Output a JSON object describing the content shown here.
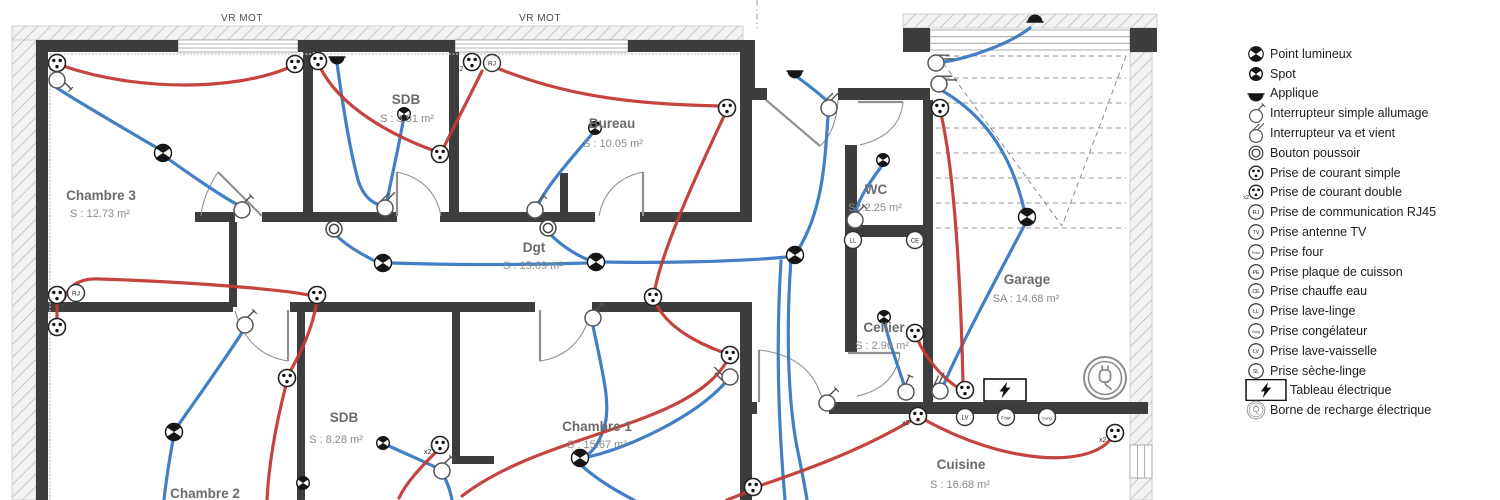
{
  "colors": {
    "wall": "#3d3d3d",
    "wire_blue": "#3878c2",
    "wire_red": "#c23a36",
    "door": "#909090",
    "hatch": "#b3b3b3",
    "stairs": "#9a9a9a",
    "room_name": "#6b6b6b",
    "room_area": "#8a8a8a",
    "legend_text": "#1d1d1d"
  },
  "legend": {
    "items": [
      {
        "symbol": "point-lumineux",
        "label": "Point lumineux"
      },
      {
        "symbol": "spot",
        "label": "Spot"
      },
      {
        "symbol": "applique",
        "label": "Applique"
      },
      {
        "symbol": "int-simple",
        "label": "Interrupteur simple allumage"
      },
      {
        "symbol": "int-vv",
        "label": "Interrupteur va et vient"
      },
      {
        "symbol": "bouton",
        "label": "Bouton poussoir"
      },
      {
        "symbol": "prise",
        "label": "Prise de courant simple"
      },
      {
        "symbol": "prise-x2",
        "label": "Prise de courant double"
      },
      {
        "symbol": "rj45",
        "label": "Prise de communication RJ45"
      },
      {
        "symbol": "tv",
        "label": "Prise antenne TV"
      },
      {
        "symbol": "four",
        "label": "Prise four"
      },
      {
        "symbol": "pe",
        "label": "Prise plaque de cuisson"
      },
      {
        "symbol": "ce",
        "label": "Prise chauffe eau"
      },
      {
        "symbol": "ll",
        "label": "Prise lave-linge"
      },
      {
        "symbol": "cong",
        "label": "Prise congélateur"
      },
      {
        "symbol": "lv",
        "label": "Prise lave-vaisselle"
      },
      {
        "symbol": "sl",
        "label": "Prise sèche-linge"
      },
      {
        "symbol": "tableau",
        "label": "Tableau électrique"
      },
      {
        "symbol": "borne",
        "label": "Borne de recharge électrique"
      }
    ]
  },
  "plan": {
    "window_labels": [
      {
        "text": "VR MOT",
        "x": 242,
        "y": 21
      },
      {
        "text": "VR MOT",
        "x": 540,
        "y": 21
      }
    ],
    "rooms": [
      {
        "name": "Chambre 3",
        "area": "S : 12.73 m²",
        "x": 101,
        "y": 200,
        "ax": 100,
        "ay": 217
      },
      {
        "name": "SDB",
        "area": "S : 3.91 m²",
        "x": 406,
        "y": 104,
        "ax": 407,
        "ay": 122
      },
      {
        "name": "Bureau",
        "area": "S : 10.05 m²",
        "x": 612,
        "y": 128,
        "ax": 613,
        "ay": 147
      },
      {
        "name": "WC",
        "area": "S : 2.25 m²",
        "x": 876,
        "y": 194,
        "ax": 875,
        "ay": 211
      },
      {
        "name": "Dgt",
        "area": "S : 15.69 m²",
        "x": 534,
        "y": 252,
        "ax": 533,
        "ay": 269
      },
      {
        "name": "Chambre 1",
        "area": "S : 15.67 m²",
        "x": 597,
        "y": 431,
        "ax": 597,
        "ay": 448
      },
      {
        "name": "Chambre 2",
        "area": "",
        "x": 205,
        "y": 498,
        "ax": 205,
        "ay": 516
      },
      {
        "name": "SDB",
        "area": "S : 8.28 m²",
        "x": 344,
        "y": 422,
        "ax": 336,
        "ay": 443
      },
      {
        "name": "Cellier",
        "area": "S : 2.96 m²",
        "x": 884,
        "y": 332,
        "ax": 882,
        "ay": 349
      },
      {
        "name": "Garage",
        "area": "SA : 14.68 m²",
        "x": 1027,
        "y": 284,
        "ax": 1026,
        "ay": 302
      },
      {
        "name": "Cuisine",
        "area": "S : 16.68 m²",
        "x": 961,
        "y": 469,
        "ax": 960,
        "ay": 488
      }
    ],
    "walls": [
      [
        36,
        40,
        12,
        460
      ],
      [
        36,
        40,
        142,
        12
      ],
      [
        298,
        40,
        157,
        12
      ],
      [
        628,
        40,
        127,
        12
      ],
      [
        743,
        52,
        12,
        40
      ],
      [
        743,
        88,
        24,
        12
      ],
      [
        838,
        88,
        92,
        12
      ],
      [
        740,
        52,
        12,
        170
      ],
      [
        740,
        302,
        12,
        198
      ],
      [
        845,
        145,
        12,
        80
      ],
      [
        845,
        225,
        88,
        12
      ],
      [
        845,
        237,
        12,
        115
      ],
      [
        923,
        100,
        10,
        310
      ],
      [
        303,
        52,
        10,
        166
      ],
      [
        449,
        52,
        10,
        166
      ],
      [
        560,
        173,
        8,
        47
      ],
      [
        195,
        212,
        40,
        10
      ],
      [
        262,
        212,
        135,
        10
      ],
      [
        440,
        212,
        155,
        10
      ],
      [
        640,
        212,
        100,
        10
      ],
      [
        229,
        222,
        8,
        85
      ],
      [
        48,
        302,
        185,
        10
      ],
      [
        290,
        302,
        245,
        10
      ],
      [
        592,
        302,
        148,
        10
      ],
      [
        297,
        307,
        8,
        193
      ],
      [
        452,
        307,
        8,
        156
      ],
      [
        452,
        456,
        42,
        8
      ],
      [
        740,
        402,
        17,
        12
      ],
      [
        829,
        402,
        319,
        12
      ],
      [
        903,
        28,
        27,
        24
      ],
      [
        1130,
        28,
        27,
        24
      ]
    ],
    "hatch_bands": [
      [
        12,
        28,
        24,
        472
      ],
      [
        12,
        26,
        731,
        14
      ],
      [
        903,
        14,
        254,
        14
      ],
      [
        1130,
        52,
        22,
        448
      ]
    ],
    "windows": [
      {
        "x": 178,
        "y": 40,
        "w": 120,
        "h": 12,
        "v": false
      },
      {
        "x": 455,
        "y": 40,
        "w": 173,
        "h": 12,
        "v": false
      },
      {
        "x": 930,
        "y": 30,
        "w": 200,
        "h": 20,
        "v": false
      },
      {
        "x": 1130,
        "y": 445,
        "w": 22,
        "h": 33,
        "v": true
      }
    ],
    "insulation": [
      [
        50,
        54,
        740,
        54
      ],
      [
        50,
        54,
        50,
        500
      ]
    ],
    "boundary_dashdot": [
      [
        757,
        0,
        757,
        28
      ]
    ],
    "stairs": {
      "x1": 936,
      "x2": 1126,
      "h_lines": [
        78,
        103,
        128,
        153,
        178,
        203,
        228
      ],
      "diagonals": [
        [
          938,
          56,
          1062,
          226
        ],
        [
          1126,
          56,
          1062,
          226
        ],
        [
          936,
          56,
          1126,
          56
        ]
      ]
    },
    "doors": [
      {
        "leaf": "M262,216 L218,172",
        "arc": "M218,172 Q203,195 201,216"
      },
      {
        "leaf": "M397,216 L397,172",
        "arc": "M397,172 Q434,180 441,216"
      },
      {
        "leaf": "M643,216 L643,172",
        "arc": "M643,172 Q606,180 599,216"
      },
      {
        "leaf": "M858,102 L903,102",
        "arc": "M903,102 Q900,135 860,145"
      },
      {
        "leaf": "M766,100 L820,146",
        "arc": "M838,100 Q836,132 820,146"
      },
      {
        "leaf": "M848,353 L900,353",
        "arc": "M900,353 Q895,388 857,396"
      },
      {
        "leaf": "M288,310 L288,361",
        "arc": "M288,361 Q248,355 235,311"
      },
      {
        "leaf": "M540,310 L540,361",
        "arc": "M540,361 Q580,355 591,311"
      },
      {
        "leaf": "M759,402 L759,350",
        "arc": "M759,350 Q812,356 823,402"
      }
    ],
    "wires": [
      {
        "c": "blue",
        "d": "M57,88 C80,103 130,132 159,149"
      },
      {
        "c": "blue",
        "d": "M167,158 C192,176 223,197 238,205"
      },
      {
        "c": "blue",
        "d": "M337,63 C342,100 350,150 358,180 C363,196 372,203 380,205"
      },
      {
        "c": "blue",
        "d": "M403,122 C398,150 391,180 387,201"
      },
      {
        "c": "blue",
        "d": "M592,134 C570,160 547,186 539,203"
      },
      {
        "c": "blue",
        "d": "M881,167 C869,183 858,200 856,212"
      },
      {
        "c": "blue",
        "d": "M796,76 C808,85 820,94 826,100"
      },
      {
        "c": "blue",
        "d": "M828,116 C825,160 823,210 798,250"
      },
      {
        "c": "blue",
        "d": "M787,257 C735,262 655,263 604,262"
      },
      {
        "c": "blue",
        "d": "M588,263 C520,265 450,265 391,263"
      },
      {
        "c": "blue",
        "d": "M375,261 C357,252 344,243 337,236"
      },
      {
        "c": "blue",
        "d": "M551,235 C563,247 578,256 589,260"
      },
      {
        "c": "blue",
        "d": "M1030,28 C1008,45 968,58 944,62"
      },
      {
        "c": "blue",
        "d": "M941,90 C990,118 1013,162 1024,209"
      },
      {
        "c": "blue",
        "d": "M1024,226 C1000,272 962,342 944,384"
      },
      {
        "c": "blue",
        "d": "M885,324 C890,346 899,368 904,385"
      },
      {
        "c": "blue",
        "d": "M593,326 C601,366 611,402 605,424 C600,443 592,452 586,456"
      },
      {
        "c": "blue",
        "d": "M588,457 C630,447 693,418 725,383"
      },
      {
        "c": "blue",
        "d": "M582,466 C598,480 616,491 634,500"
      },
      {
        "c": "blue",
        "d": "M177,427 C200,394 230,352 243,331"
      },
      {
        "c": "blue",
        "d": "M173,440 C169,462 166,481 164,500"
      },
      {
        "c": "blue",
        "d": "M389,446 C406,454 423,461 435,467"
      },
      {
        "c": "blue",
        "d": "M445,478 C449,487 451,494 452,500"
      },
      {
        "c": "blue",
        "d": "M791,259 C786,330 788,395 796,442 C801,468 805,486 807,500"
      },
      {
        "c": "blue",
        "d": "M781,261 C776,340 778,420 785,500"
      },
      {
        "c": "red",
        "d": "M63,66 C140,92 235,90 288,68"
      },
      {
        "c": "red",
        "d": "M320,67 C340,108 394,136 432,150"
      },
      {
        "c": "red",
        "d": "M482,71 C466,104 452,130 444,147"
      },
      {
        "c": "red",
        "d": "M497,68 C575,100 648,104 719,106"
      },
      {
        "c": "red",
        "d": "M725,114 C701,165 664,244 655,289"
      },
      {
        "c": "red",
        "d": "M656,303 C667,328 700,344 722,352"
      },
      {
        "c": "red",
        "d": "M727,361 C688,428 545,432 462,496"
      },
      {
        "c": "red",
        "d": "M941,114 C956,180 961,300 963,382"
      },
      {
        "c": "red",
        "d": "M917,338 C927,362 946,380 957,387"
      },
      {
        "c": "red",
        "d": "M912,420 C858,452 800,472 759,486"
      },
      {
        "c": "red",
        "d": "M749,491 C740,495 732,498 727,500"
      },
      {
        "c": "red",
        "d": "M925,420 C1005,464 1086,468 1110,440"
      },
      {
        "c": "red",
        "d": "M317,301 C311,336 297,358 290,372"
      },
      {
        "c": "red",
        "d": "M286,385 C277,420 269,460 267,500"
      },
      {
        "c": "red",
        "d": "M64,299 C70,282 85,278 100,279 C190,282 278,289 309,295"
      },
      {
        "c": "red",
        "d": "M437,451 C420,468 406,483 399,498"
      },
      {
        "c": "red",
        "d": "M57,320 L57,302"
      }
    ],
    "symbols": [
      {
        "t": "prise",
        "x": 57,
        "y": 63
      },
      {
        "t": "int-simple",
        "x": 57,
        "y": 80,
        "r": 90
      },
      {
        "t": "point-lumineux",
        "x": 163,
        "y": 153
      },
      {
        "t": "int-simple",
        "x": 242,
        "y": 210
      },
      {
        "t": "prise",
        "x": 295,
        "y": 64
      },
      {
        "t": "prise",
        "x": 318,
        "y": 61
      },
      {
        "t": "applique",
        "x": 337,
        "y": 57
      },
      {
        "t": "spot",
        "x": 404,
        "y": 114
      },
      {
        "t": "int-vv",
        "x": 385,
        "y": 208
      },
      {
        "t": "bouton",
        "x": 334,
        "y": 229
      },
      {
        "t": "prise",
        "x": 440,
        "y": 154
      },
      {
        "t": "prise-x2",
        "x": 472,
        "y": 62
      },
      {
        "t": "rj45",
        "x": 492,
        "y": 63
      },
      {
        "t": "spot",
        "x": 595,
        "y": 128
      },
      {
        "t": "int-simple",
        "x": 535,
        "y": 210
      },
      {
        "t": "bouton",
        "x": 548,
        "y": 228
      },
      {
        "t": "point-lumineux",
        "x": 383,
        "y": 263
      },
      {
        "t": "point-lumineux",
        "x": 596,
        "y": 262
      },
      {
        "t": "point-lumineux",
        "x": 795,
        "y": 255
      },
      {
        "t": "applique",
        "x": 795,
        "y": 71
      },
      {
        "t": "int-vv",
        "x": 829,
        "y": 108
      },
      {
        "t": "prise",
        "x": 727,
        "y": 108
      },
      {
        "t": "spot",
        "x": 883,
        "y": 160
      },
      {
        "t": "int-simple",
        "x": 855,
        "y": 220
      },
      {
        "t": "ll",
        "x": 853,
        "y": 240
      },
      {
        "t": "ce",
        "x": 915,
        "y": 240
      },
      {
        "t": "applique",
        "x": 1035,
        "y": 22,
        "r": 180
      },
      {
        "t": "int-vv",
        "x": 936,
        "y": 63,
        "r": 45
      },
      {
        "t": "int-vv",
        "x": 939,
        "y": 84,
        "r": 45
      },
      {
        "t": "prise",
        "x": 940,
        "y": 108
      },
      {
        "t": "point-lumineux",
        "x": 1027,
        "y": 217
      },
      {
        "t": "spot",
        "x": 884,
        "y": 317
      },
      {
        "t": "prise",
        "x": 915,
        "y": 333
      },
      {
        "t": "int-simple",
        "x": 906,
        "y": 392,
        "r": -20
      },
      {
        "t": "int-vv",
        "x": 940,
        "y": 391,
        "r": -20
      },
      {
        "t": "prise",
        "x": 965,
        "y": 390
      },
      {
        "t": "tableau",
        "x": 1005,
        "y": 390
      },
      {
        "t": "borne",
        "x": 1105,
        "y": 378
      },
      {
        "t": "prise-x2",
        "x": 918,
        "y": 416
      },
      {
        "t": "lv",
        "x": 965,
        "y": 417
      },
      {
        "t": "four",
        "x": 1006,
        "y": 417
      },
      {
        "t": "cong",
        "x": 1047,
        "y": 417
      },
      {
        "t": "prise-x2",
        "x": 1115,
        "y": 433
      },
      {
        "t": "prise",
        "x": 753,
        "y": 487
      },
      {
        "t": "int-simple",
        "x": 827,
        "y": 403
      },
      {
        "t": "prise",
        "x": 57,
        "y": 295
      },
      {
        "t": "rj45",
        "x": 76,
        "y": 293
      },
      {
        "t": "prise",
        "x": 57,
        "y": 327
      },
      {
        "t": "prise",
        "x": 317,
        "y": 295
      },
      {
        "t": "prise",
        "x": 287,
        "y": 378
      },
      {
        "t": "point-lumineux",
        "x": 174,
        "y": 432
      },
      {
        "t": "int-simple",
        "x": 245,
        "y": 325
      },
      {
        "t": "spot",
        "x": 303,
        "y": 483
      },
      {
        "t": "spot",
        "x": 383,
        "y": 443
      },
      {
        "t": "prise-x2",
        "x": 440,
        "y": 445
      },
      {
        "t": "int-simple",
        "x": 442,
        "y": 471
      },
      {
        "t": "point-lumineux",
        "x": 580,
        "y": 458
      },
      {
        "t": "int-simple",
        "x": 593,
        "y": 318
      },
      {
        "t": "int-vv",
        "x": 730,
        "y": 377,
        "r": -90
      },
      {
        "t": "prise",
        "x": 653,
        "y": 297
      },
      {
        "t": "prise",
        "x": 730,
        "y": 355
      }
    ]
  }
}
